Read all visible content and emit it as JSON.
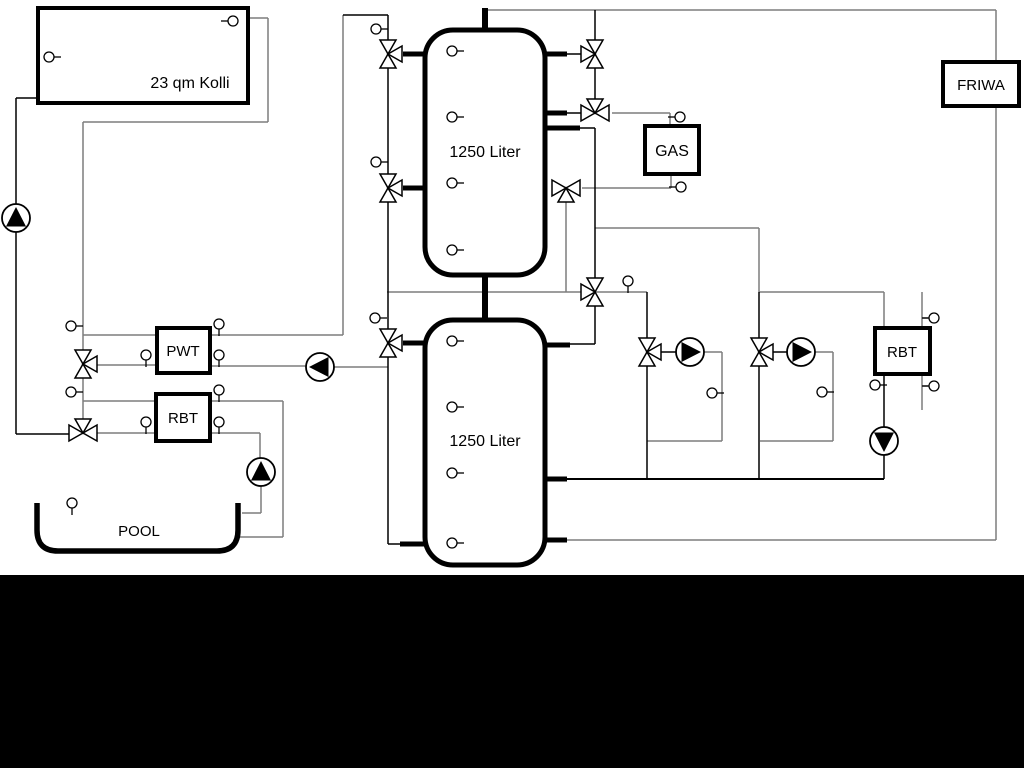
{
  "scene": {
    "type": "hydraulic-heating-schematic",
    "background": "#ffffff",
    "bottom_band_color": "#000000"
  },
  "labels": {
    "solar_collector": "23 qm Kolli",
    "buffer_tank_upper": "1250 Liter",
    "buffer_tank_lower": "1250 Liter",
    "plate_heat_exchanger": "PWT",
    "pool_heat_exchanger": "RBT",
    "gas_boiler": "GAS",
    "fresh_water_station": "FRIWA",
    "right_heat_exchanger": "RBT",
    "pool": "POOL"
  },
  "colors": {
    "line_primary": "#000000",
    "line_secondary": "#7d7d7d",
    "symbol_fill": "#ffffff"
  }
}
